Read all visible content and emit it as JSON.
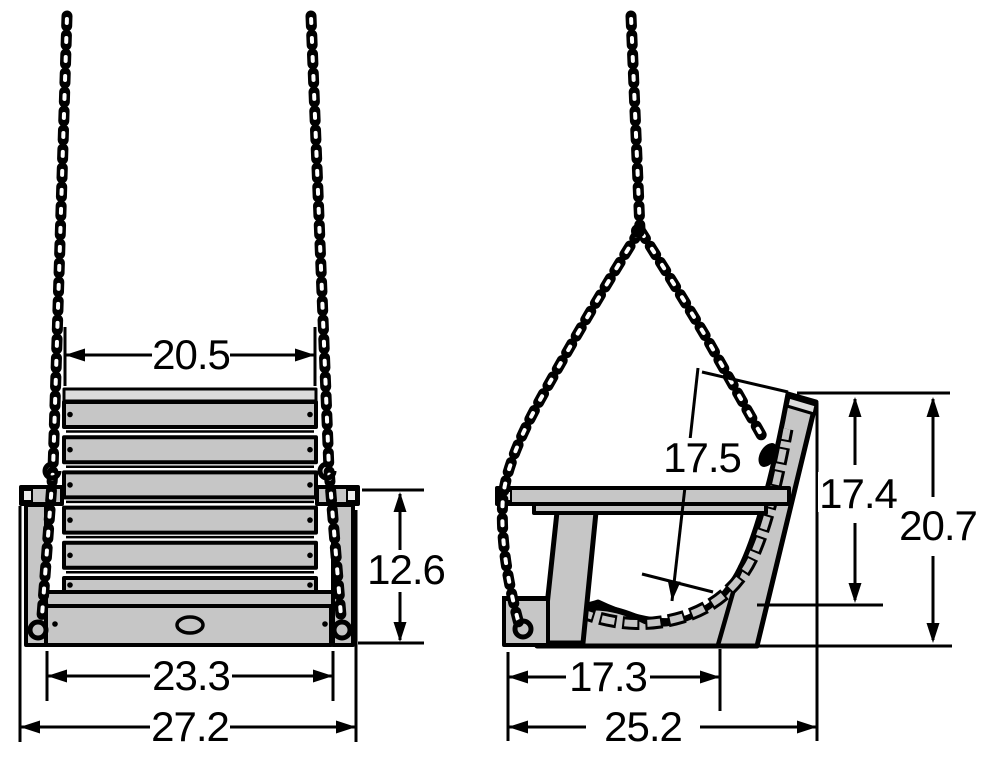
{
  "diagram": {
    "subject": "porch-swing-dimension-drawing",
    "views": {
      "left": "front view of hanging porch swing",
      "right": "side view of hanging porch swing"
    },
    "colors": {
      "outline": "#000000",
      "wood_fill": "#c6c6c6",
      "end_cap": "#ececec",
      "background": "#ffffff"
    },
    "dims": {
      "front_back_width": "20.5",
      "front_side_height": "12.6",
      "front_base_width": "23.3",
      "front_overall_width": "27.2",
      "side_seat_diagonal": "17.5",
      "side_back_height": "17.4",
      "side_overall_height": "20.7",
      "side_seat_depth": "17.3",
      "side_overall_depth": "25.2"
    }
  }
}
